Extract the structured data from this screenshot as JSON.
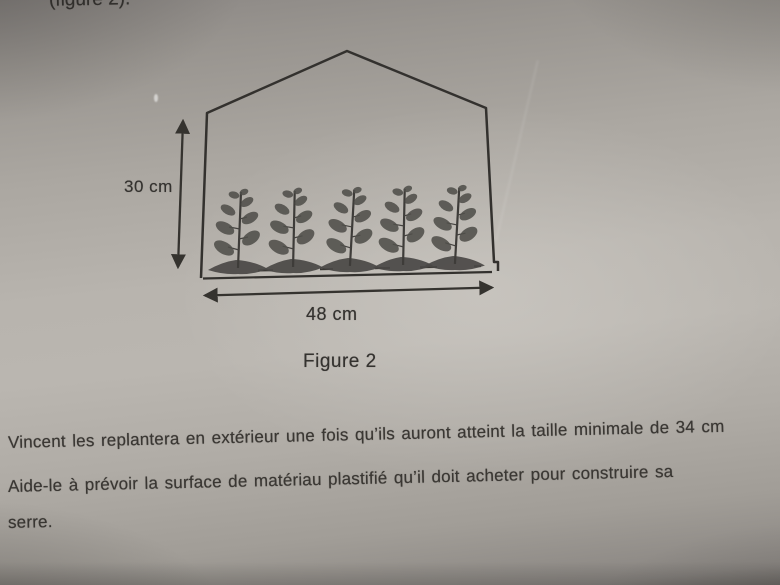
{
  "photo": {
    "top_caption": "(figure 2).",
    "figure": {
      "height_label": "30 cm",
      "width_label": "48 cm",
      "caption": "Figure 2",
      "plant_count": 5
    },
    "paragraph": {
      "line1": "Vincent les replantera en extérieur une fois qu’ils auront atteint la taille minimale de 34 cm",
      "line2": "Aide-le à prévoir la surface de matériau plastifié qu’il doit acheter pour construire sa",
      "line3": "serre."
    },
    "colors": {
      "paper_light": "#bab6b0",
      "paper_shadow": "#8a8682",
      "ink": "#35332f"
    }
  }
}
